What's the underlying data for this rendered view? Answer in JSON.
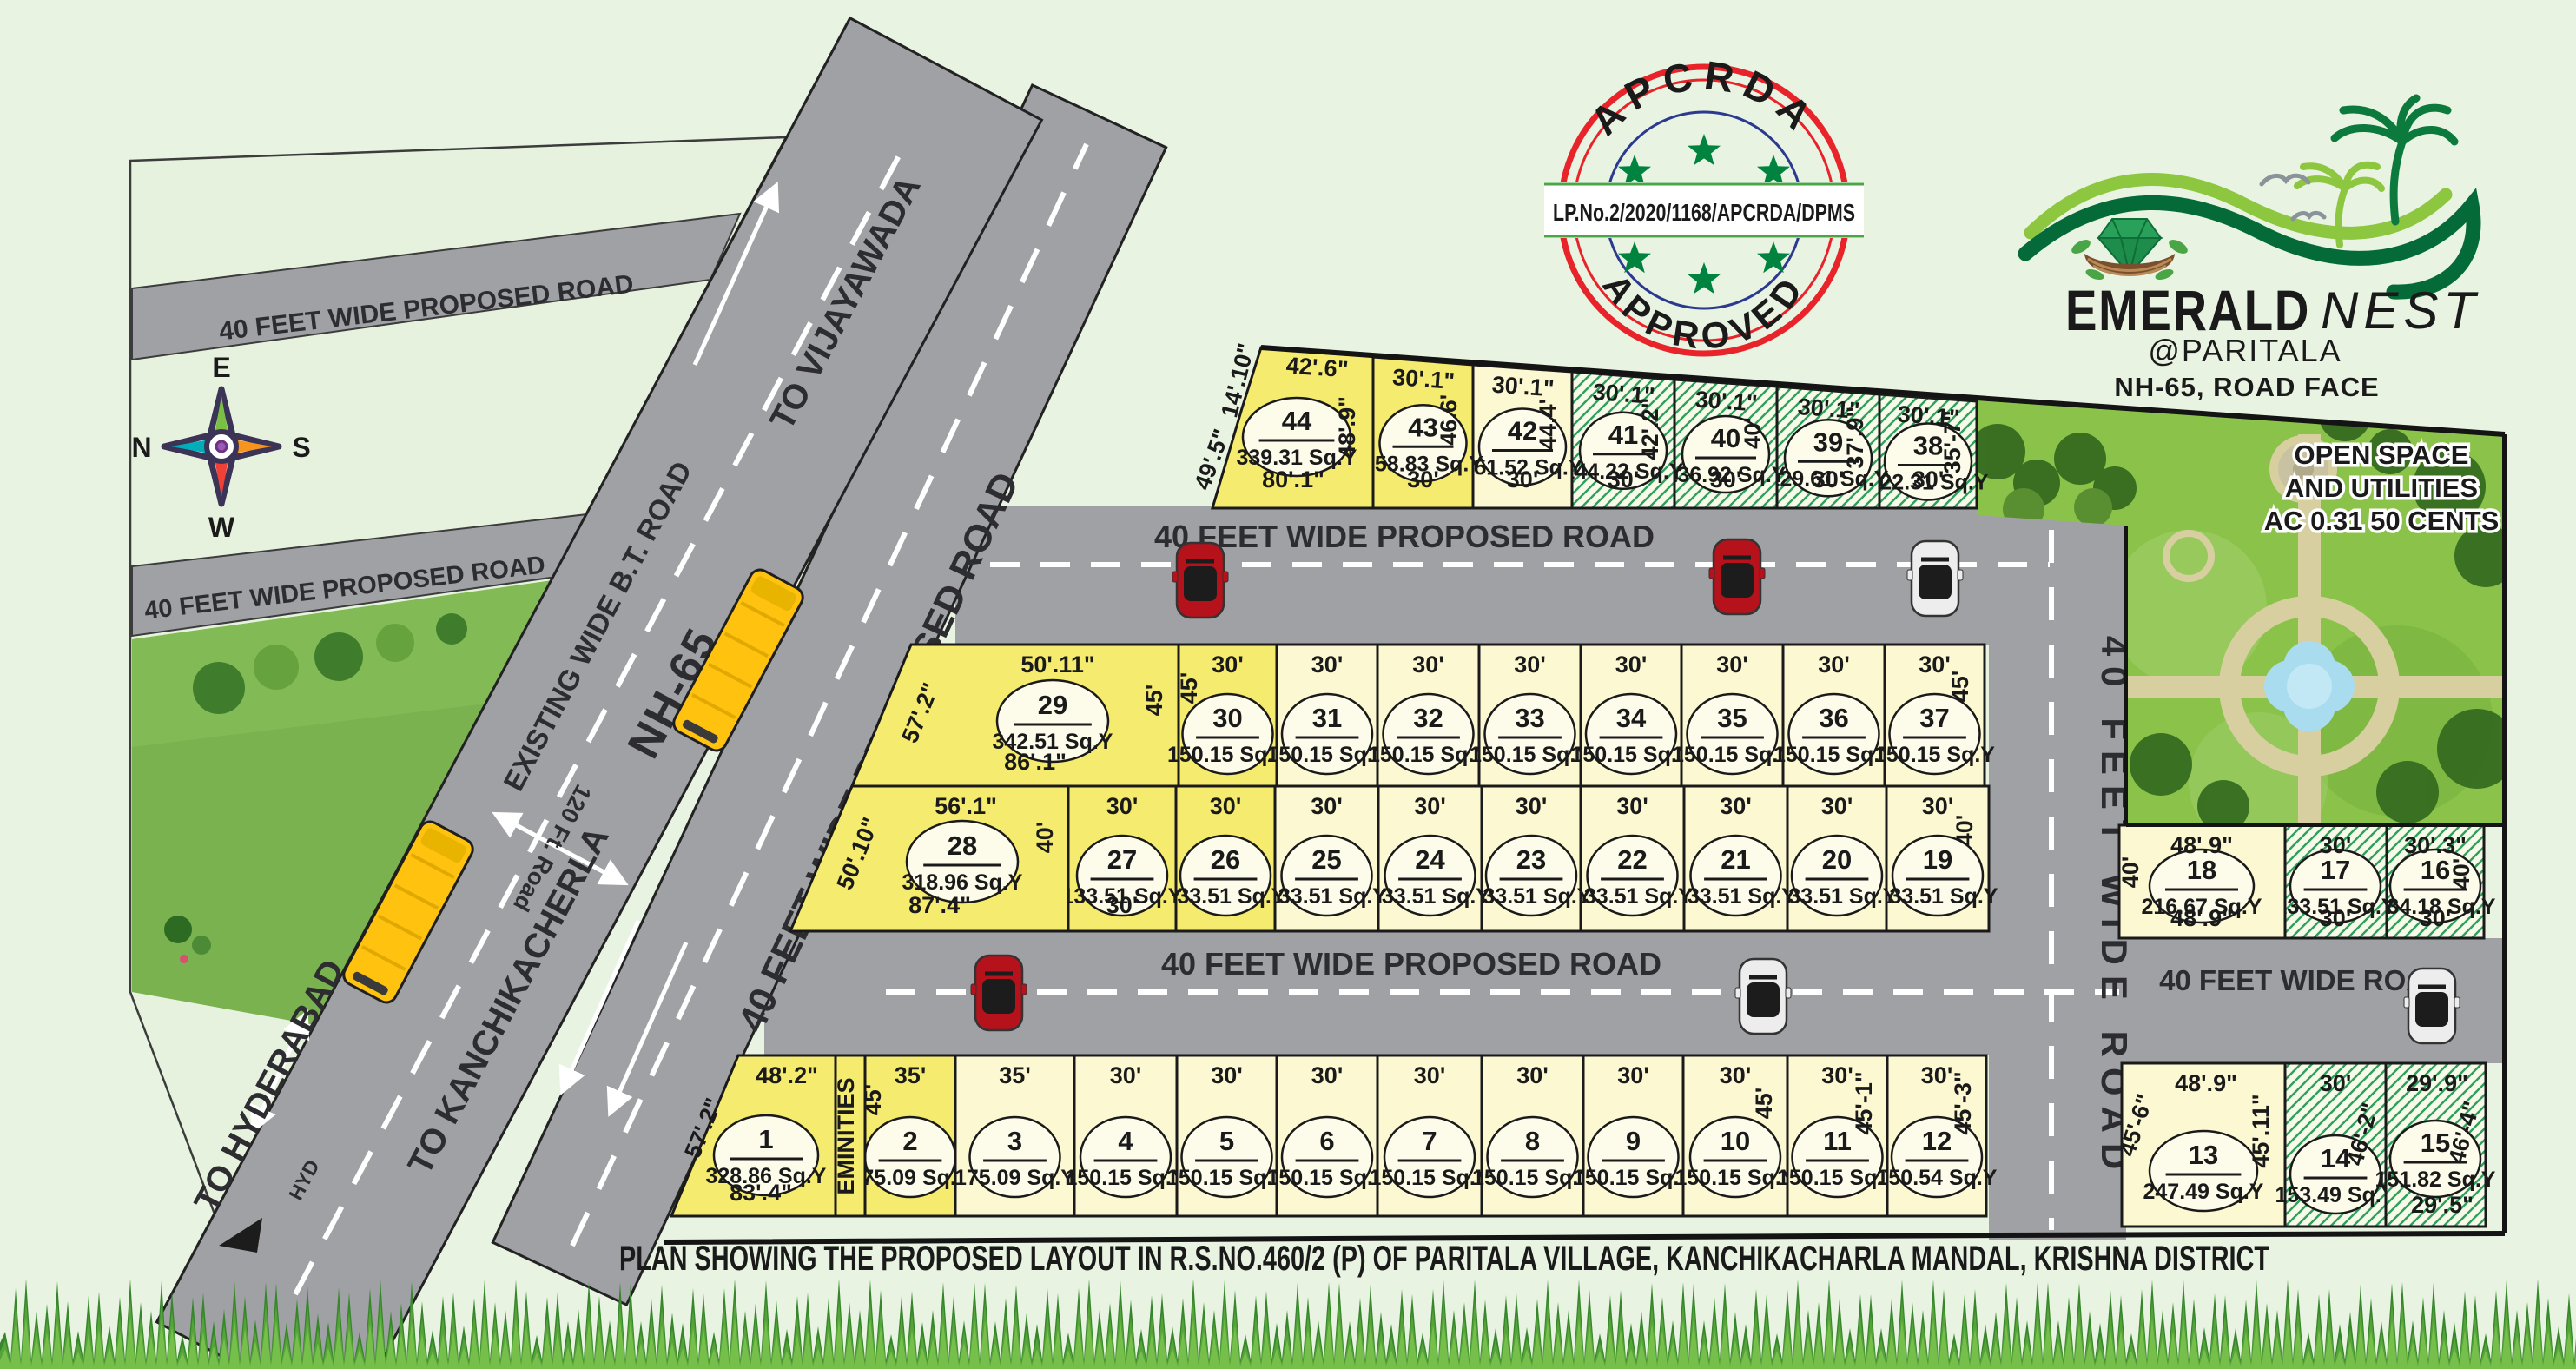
{
  "title": "PLAN SHOWING THE PROPOSED LAYOUT IN R.S.NO.460/2 (P) OF PARITALA VILLAGE, KANCHIKACHARLA MANDAL, KRISHNA DISTRICT",
  "logo": {
    "name1": "EMERALD",
    "name2": "NEST",
    "location": "@PARITALA",
    "tagline": "NH-65, ROAD FACE"
  },
  "stamp": {
    "arc_top": "APCRDA",
    "arc_bottom": "APPROVED",
    "banner": "LP.No.2/2020/1168/APCRDA/DPMS"
  },
  "compass": {
    "top": "E",
    "left": "N",
    "right": "S",
    "bottom": "W"
  },
  "open_space": {
    "line1": "OPEN SPACE",
    "line2": "AND UTILITIES",
    "line3": "AC 0.31 50 CENTS"
  },
  "eminities_label": "EMINITIES",
  "area_unit": "Sq.Y",
  "roads": {
    "left_band_a": "40 FEET WIDE PROPOSED ROAD",
    "left_band_b": "40 FEET  WIDE PROPOSED ROAD",
    "nh65": {
      "to_top": "TO VIJAYAWADA",
      "existing": "EXISTING WIDE B.T. ROAD",
      "name": "NH-65",
      "ft120": "120 Ft. Road",
      "to_bottom": "TO KANCHIKACHERLA",
      "to_hyderabad": "TO HYDERABAD",
      "hyd": "HYD"
    },
    "diagonal": "40 FEET WIDE PROPOSED ROAD",
    "road1": "40 FEET WIDE PROPOSED ROAD",
    "road2": "40 FEET WIDE PROPOSED ROAD",
    "vertical": "40 FEET WIDE ROAD",
    "road3": "40 FEET WIDE ROAD"
  },
  "colors": {
    "background": "#e8f3e2",
    "road_gray": "#a0a1a5",
    "plot_yellow": "#f5eb6e",
    "plot_cream": "#fcf8d2",
    "hatch_green": "#2fa05c",
    "ellipse_fill": "#fdfbe9",
    "boundary_black": "#141414",
    "brand_green": "#00833e",
    "brand_light_green": "#8dc63f",
    "brand_pink": "#ec268f",
    "stamp_red": "#e8232a",
    "stamp_blue": "#2b3990",
    "star_green": "#00833e",
    "bus_yellow": "#ffc20e",
    "car_red": "#b5121b",
    "car_white": "#ededed"
  },
  "plots": [
    {
      "n": "1",
      "area_label": "328.86 Sq.Y",
      "top": "48'.2\"",
      "bottom": "83'.4\"",
      "left": "57'.2\"",
      "highlight": "yellow"
    },
    {
      "n": "2",
      "area_label": "175.09 Sq.Y",
      "top": "35'",
      "left": "45'",
      "highlight": "yellow"
    },
    {
      "n": "3",
      "area_label": "175.09 Sq.Y",
      "top": "35'",
      "highlight": "cream"
    },
    {
      "n": "4",
      "area_label": "150.15 Sq.Y",
      "top": "30'",
      "highlight": "cream"
    },
    {
      "n": "5",
      "area_label": "150.15 Sq.Y",
      "top": "30'",
      "highlight": "cream"
    },
    {
      "n": "6",
      "area_label": "150.15 Sq.Y",
      "top": "30'",
      "highlight": "cream"
    },
    {
      "n": "7",
      "area_label": "150.15 Sq.Y",
      "top": "30'",
      "highlight": "cream"
    },
    {
      "n": "8",
      "area_label": "150.15 Sq.Y",
      "top": "30'",
      "highlight": "cream"
    },
    {
      "n": "9",
      "area_label": "150.15 Sq.Y",
      "top": "30'",
      "highlight": "cream"
    },
    {
      "n": "10",
      "area_label": "150.15 Sq.Y",
      "top": "30'",
      "right": "45'",
      "highlight": "cream"
    },
    {
      "n": "11",
      "area_label": "150.15 Sq.Y",
      "top": "30'",
      "right": "45'-1\"",
      "highlight": "cream"
    },
    {
      "n": "12",
      "area_label": "150.54 Sq.Y",
      "top": "30'",
      "right": "45'-3\"",
      "highlight": "cream"
    },
    {
      "n": "13",
      "area_label": "247.49 Sq.Y",
      "top": "48'.9\"",
      "left": "45'-6\"",
      "right": "45'.11\"",
      "highlight": "cream"
    },
    {
      "n": "14",
      "area_label": "153.49 Sq.Y",
      "top": "30'",
      "right": "46'-2\"",
      "highlight": "hatched"
    },
    {
      "n": "15",
      "area_label": "151.82 Sq.Y",
      "top": "29'.9\"",
      "bottom": "29'.5\"",
      "right": "46'-4\"",
      "highlight": "hatched"
    },
    {
      "n": "16",
      "area_label": "134.18 Sq.Y",
      "top": "30'.3\"",
      "bottom": "30'",
      "right": "40'",
      "highlight": "hatched"
    },
    {
      "n": "17",
      "area_label": "133.51 Sq.Y",
      "top": "30'",
      "bottom": "30'",
      "highlight": "hatched"
    },
    {
      "n": "18",
      "area_label": "216.67 Sq.Y",
      "top": "48'.9\"",
      "bottom": "48'.9\"",
      "left": "40'",
      "highlight": "cream"
    },
    {
      "n": "19",
      "area_label": "133.51 Sq.Y",
      "top": "30'",
      "right": "40'",
      "highlight": "cream"
    },
    {
      "n": "20",
      "area_label": "133.51 Sq.Y",
      "top": "30'",
      "highlight": "cream"
    },
    {
      "n": "21",
      "area_label": "133.51 Sq.Y",
      "top": "30'",
      "highlight": "cream"
    },
    {
      "n": "22",
      "area_label": "133.51 Sq.Y",
      "top": "30'",
      "highlight": "cream"
    },
    {
      "n": "23",
      "area_label": "133.51 Sq.Y",
      "top": "30'",
      "highlight": "cream"
    },
    {
      "n": "24",
      "area_label": "133.51 Sq.Y",
      "top": "30'",
      "highlight": "cream"
    },
    {
      "n": "25",
      "area_label": "133.51 Sq.Y",
      "top": "30'",
      "highlight": "cream"
    },
    {
      "n": "26",
      "area_label": "133.51 Sq.Y",
      "top": "30'",
      "highlight": "yellow"
    },
    {
      "n": "27",
      "area_label": "133.51 Sq.Y",
      "top": "30'",
      "bottom": "30'",
      "highlight": "yellow"
    },
    {
      "n": "28",
      "area_label": "318.96 Sq.Y",
      "top": "56'.1\"",
      "bottom": "87'.4\"",
      "left": "50'.10\"",
      "right": "40'",
      "highlight": "yellow"
    },
    {
      "n": "29",
      "area_label": "342.51 Sq.Y",
      "top": "50'.11\"",
      "bottom": "86'.1\"",
      "left": "57'.2\"",
      "right": "45'",
      "highlight": "yellow"
    },
    {
      "n": "30",
      "area_label": "150.15 Sq.Y",
      "top": "30'",
      "left": "45'",
      "highlight": "yellow"
    },
    {
      "n": "31",
      "area_label": "150.15 Sq.Y",
      "top": "30'",
      "highlight": "cream"
    },
    {
      "n": "32",
      "area_label": "150.15 Sq.Y",
      "top": "30'",
      "highlight": "cream"
    },
    {
      "n": "33",
      "area_label": "150.15 Sq.Y",
      "top": "30'",
      "highlight": "cream"
    },
    {
      "n": "34",
      "area_label": "150.15 Sq.Y",
      "top": "30'",
      "highlight": "cream"
    },
    {
      "n": "35",
      "area_label": "150.15 Sq.Y",
      "top": "30'",
      "highlight": "cream"
    },
    {
      "n": "36",
      "area_label": "150.15 Sq.Y",
      "top": "30'",
      "highlight": "cream"
    },
    {
      "n": "37",
      "area_label": "150.15 Sq.Y",
      "top": "30'",
      "right": "45'",
      "highlight": "cream"
    },
    {
      "n": "38",
      "area_label": "122.31 Sq.Y",
      "top": "30'.1\"",
      "bottom": "30'",
      "right": "35'-7\"",
      "highlight": "hatched"
    },
    {
      "n": "39",
      "area_label": "129.61 Sq.Y",
      "top": "30'.1\"",
      "bottom": "30'",
      "right": "37'.9\"",
      "highlight": "hatched"
    },
    {
      "n": "40",
      "area_label": "136.92 Sq.Y",
      "top": "30'.1\"",
      "bottom": "30'",
      "right": "40'",
      "highlight": "hatched"
    },
    {
      "n": "41",
      "area_label": "144.22 Sq.Y",
      "top": "30'.1\"",
      "bottom": "30'",
      "right": "42'.2\"",
      "highlight": "hatched"
    },
    {
      "n": "42",
      "area_label": "151.52 Sq.Y",
      "top": "30'.1\"",
      "bottom": "30'",
      "right": "44.4'",
      "highlight": "cream"
    },
    {
      "n": "43",
      "area_label": "158.83 Sq.Y",
      "top": "30'.1\"",
      "bottom": "30'",
      "right": "46.6'",
      "highlight": "yellow"
    },
    {
      "n": "44",
      "area_label": "339.31 Sq.Y",
      "top": "42'.6\"",
      "bottom": "80'.1\"",
      "left": "49'.5\"",
      "left2": "14'.10\"",
      "right": "48'.9\"",
      "highlight": "yellow"
    }
  ]
}
